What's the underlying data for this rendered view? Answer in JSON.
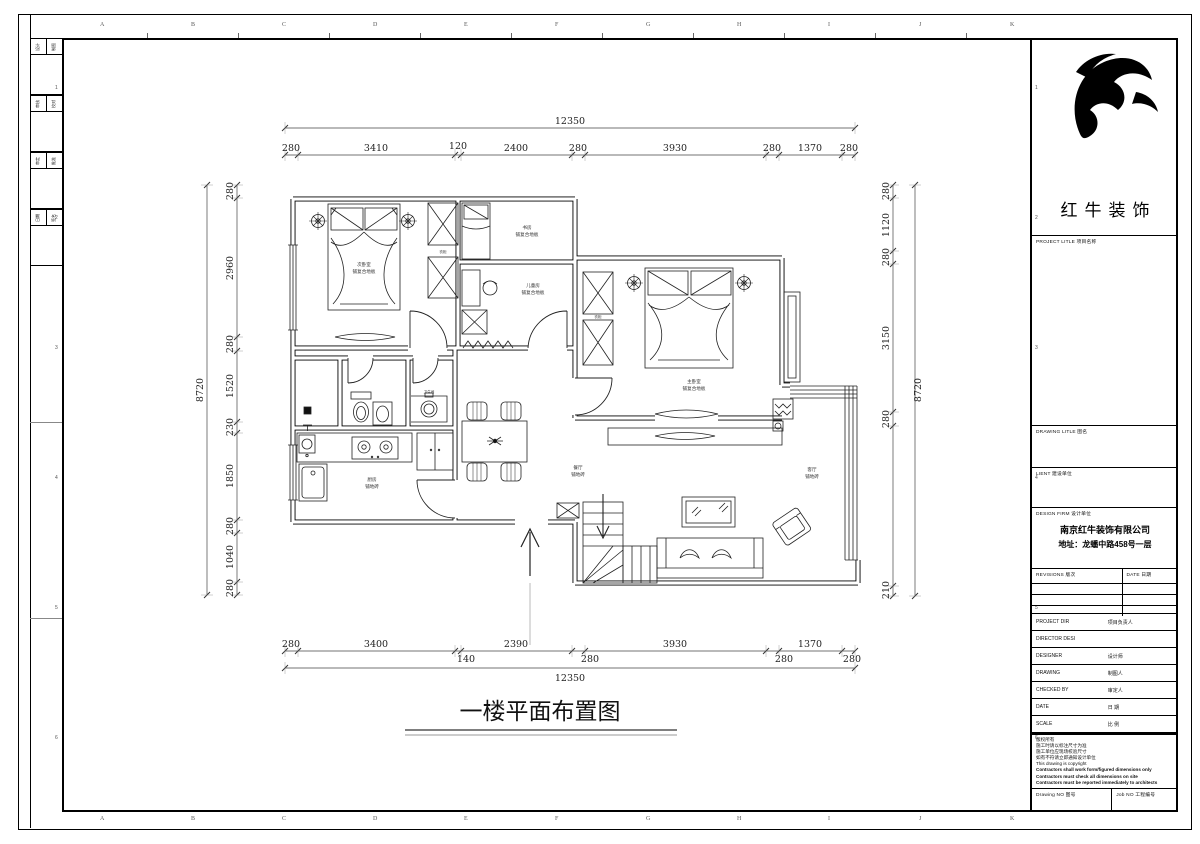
{
  "brand": {
    "name": "红牛装饰"
  },
  "frame": {
    "top_letters": [
      "A",
      "B",
      "C",
      "D",
      "E",
      "F",
      "G",
      "H",
      "I",
      "J",
      "K"
    ],
    "bottom_letters": [
      "A",
      "B",
      "C",
      "D",
      "E",
      "F",
      "G",
      "H",
      "I",
      "J",
      "K"
    ],
    "left_numbers": [
      "1",
      "2",
      "3",
      "4",
      "5",
      "6"
    ],
    "right_numbers": [
      "1",
      "2",
      "3",
      "4",
      "5",
      "6"
    ],
    "sign_rows": [
      [
        "设计",
        "制图"
      ],
      [
        "审核",
        "校对"
      ],
      [
        "审定",
        "批准"
      ],
      [
        "日期",
        "签名"
      ]
    ]
  },
  "titleblock": {
    "project_label": "PROJECT LITLE  项目名称",
    "drawing_label": "DRAWING LITLE  图名",
    "client_label": "LIENT  建设单位",
    "firm_label": "DESIGN FIRM  设计单位",
    "firm_name": "南京红牛装饰有限公司",
    "firm_addr": "地址：龙蟠中路458号一层",
    "revisions_label": "REVISIONS  版次",
    "rev_date_label": "DATE  日期",
    "rows": [
      {
        "en": "PROJECT DIR",
        "cn": "项目负责人"
      },
      {
        "en": "DIRECTOR DESI",
        "cn": ""
      },
      {
        "en": "DESIGNER",
        "cn": "设计师"
      },
      {
        "en": "DRAWING",
        "cn": "制图人"
      },
      {
        "en": "CHECKED BY",
        "cn": "审定人"
      },
      {
        "en": "DATE",
        "cn": "日  期"
      },
      {
        "en": "SCALE",
        "cn": "比  例"
      }
    ],
    "notes": [
      "版权所有",
      "施工时请以标注尺寸为准",
      "施工单位应现场校验尺寸",
      "如有不符请立即通知设计单位",
      "This drawing is copyright",
      "Contractors shall work form/figured dimensions only",
      "Contractors must check all dimensions on site",
      "Contractors must be reported immediately to architects"
    ],
    "drawing_no_label": "Drawing NO  图号",
    "job_no_label": "Job NO  工程编号"
  },
  "plan": {
    "title": "一楼平面布置图",
    "rooms": {
      "bed2": {
        "name": "次卧室",
        "finish": "铺复合地板"
      },
      "study": {
        "name": "书房",
        "finish": "铺复合地板"
      },
      "kids": {
        "name": "儿童房",
        "finish": "铺复合地板"
      },
      "master": {
        "name": "主卧室",
        "finish": "铺复合地板"
      },
      "kitchen": {
        "name": "厨房",
        "finish": "铺地砖"
      },
      "dining": {
        "name": "餐厅",
        "finish": "铺地砖"
      },
      "living": {
        "name": "客厅",
        "finish": "铺地砖"
      },
      "bath": {
        "name": "卫生间"
      },
      "wardrobe": "衣柜"
    },
    "dims": {
      "top_total": "12350",
      "top": [
        "280",
        "3410",
        "120",
        "2400",
        "280",
        "3930",
        "280",
        "1370",
        "280"
      ],
      "bottom": [
        "280",
        "3400",
        "140",
        "2390",
        "280",
        "3930",
        "280",
        "1370",
        "280"
      ],
      "bottom_total": "12350",
      "left_total": "8720",
      "left": [
        "280",
        "2960",
        "280",
        "1520",
        "230",
        "1850",
        "280",
        "1040",
        "280"
      ],
      "right": [
        "280",
        "1120",
        "280",
        "3150",
        "280",
        "210"
      ],
      "right_total": "8720"
    }
  }
}
